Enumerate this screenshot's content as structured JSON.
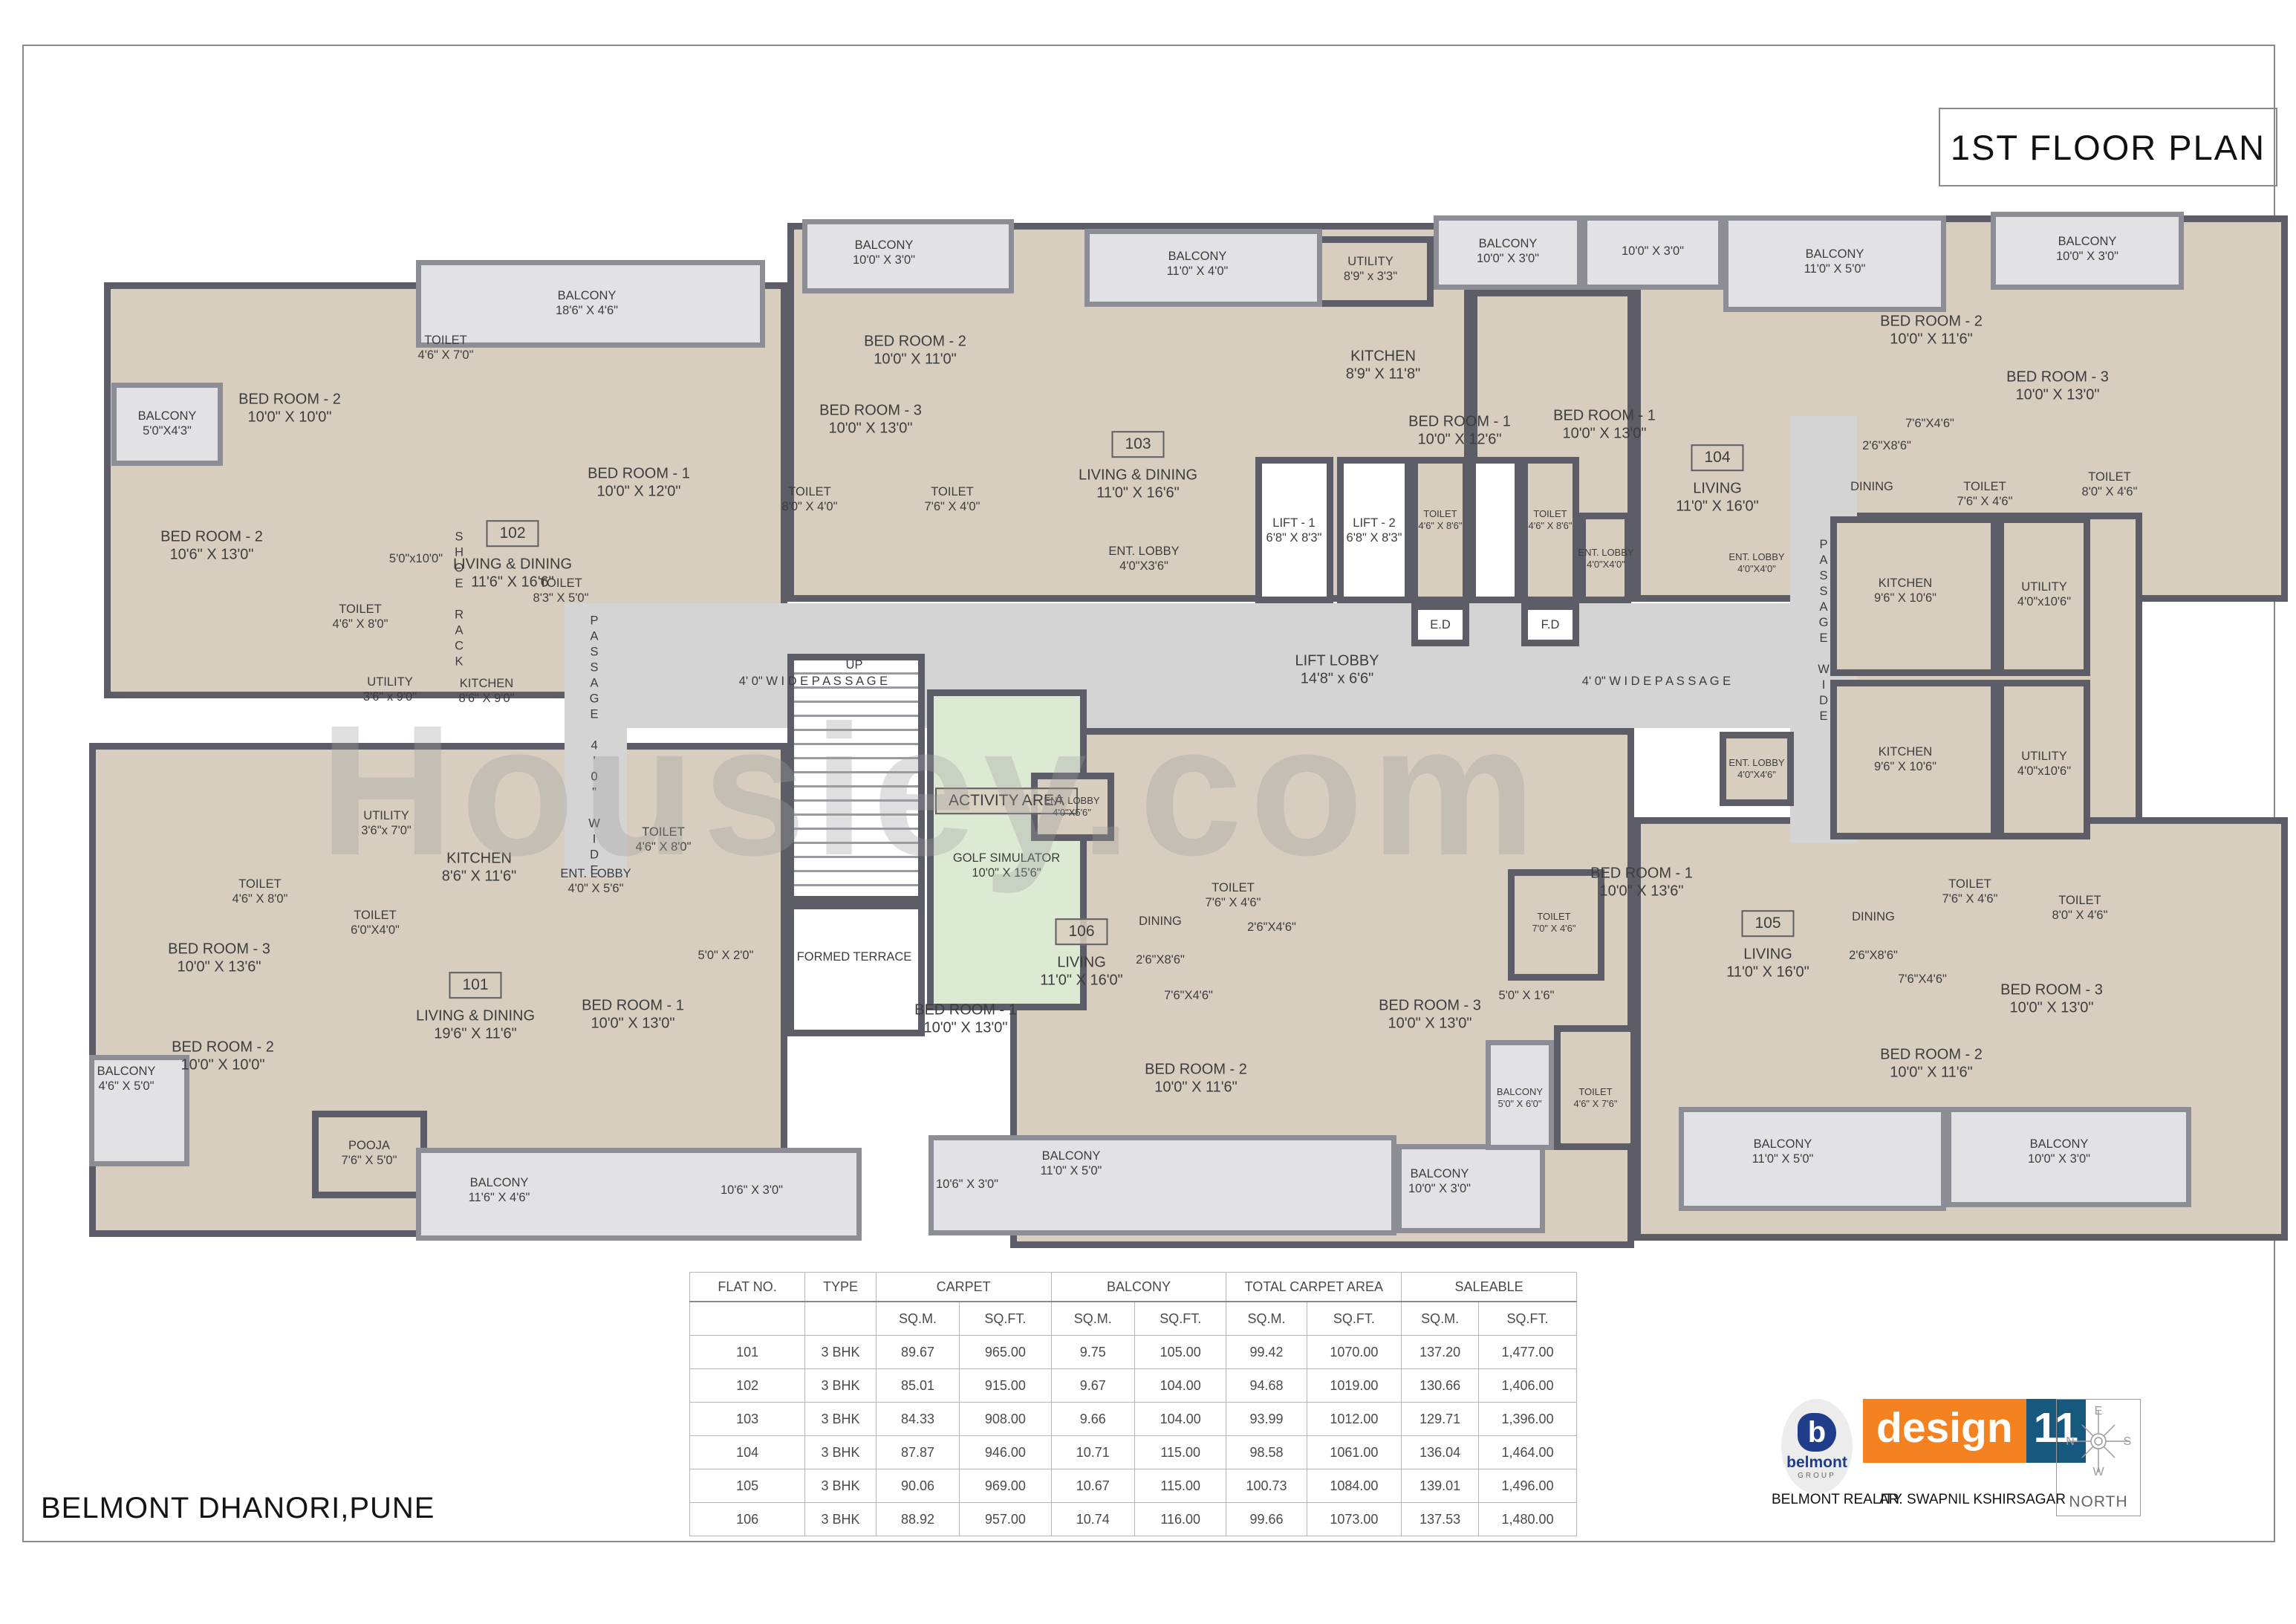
{
  "title": "1ST FLOOR PLAN",
  "project": "BELMONT  DHANORI,PUNE",
  "watermark": "Housiey.com",
  "footer": {
    "developer_label": "BELMONT REALITY",
    "architect_label": "AR. SWAPNIL  KSHIRSAGAR",
    "brand_word": "design",
    "brand_number": "11",
    "logo_letter": "b",
    "logo_name": "belmont",
    "logo_sub": "GROUP",
    "north_label": "NORTH",
    "compass": {
      "top": "E",
      "left": "N",
      "right": "S",
      "bottom": "W"
    }
  },
  "colors": {
    "room_fill": "#d8cec0",
    "wall": "#5d5d68",
    "balcony_fill": "#e2e2e4",
    "core_fill": "#d4d4d4",
    "activity_fill": "#dcead4",
    "brand_orange": "#f58220",
    "brand_blue": "#16587e",
    "logo_navy": "#1f3d8a"
  },
  "area_table": {
    "groups": [
      {
        "label": "FLAT NO.",
        "cols": 1
      },
      {
        "label": "TYPE",
        "cols": 1
      },
      {
        "label": "CARPET",
        "cols": 2
      },
      {
        "label": "BALCONY",
        "cols": 2
      },
      {
        "label": "TOTAL CARPET AREA",
        "cols": 2
      },
      {
        "label": "SALEABLE",
        "cols": 2
      }
    ],
    "unit_row": [
      "",
      "",
      "SQ.M.",
      "SQ.FT.",
      "SQ.M.",
      "SQ.FT.",
      "SQ.M.",
      "SQ.FT.",
      "SQ.M.",
      "SQ.FT."
    ],
    "rows": [
      [
        "101",
        "3 BHK",
        "89.67",
        "965.00",
        "9.75",
        "105.00",
        "99.42",
        "1070.00",
        "137.20",
        "1,477.00"
      ],
      [
        "102",
        "3 BHK",
        "85.01",
        "915.00",
        "9.67",
        "104.00",
        "94.68",
        "1019.00",
        "130.66",
        "1,406.00"
      ],
      [
        "103",
        "3 BHK",
        "84.33",
        "908.00",
        "9.66",
        "104.00",
        "93.99",
        "1012.00",
        "129.71",
        "1,396.00"
      ],
      [
        "104",
        "3 BHK",
        "87.87",
        "946.00",
        "10.71",
        "115.00",
        "98.58",
        "1061.00",
        "136.04",
        "1,464.00"
      ],
      [
        "105",
        "3 BHK",
        "90.06",
        "969.00",
        "10.67",
        "115.00",
        "100.73",
        "1084.00",
        "139.01",
        "1,496.00"
      ],
      [
        "106",
        "3 BHK",
        "88.92",
        "957.00",
        "10.74",
        "116.00",
        "99.66",
        "1073.00",
        "137.53",
        "1,480.00"
      ]
    ]
  },
  "plan": {
    "rooms": [
      [
        140,
        380,
        920,
        560,
        "r"
      ],
      [
        120,
        1000,
        940,
        665,
        "r"
      ],
      [
        1060,
        300,
        920,
        510,
        "r"
      ],
      [
        1980,
        390,
        220,
        420,
        "r"
      ],
      [
        2200,
        290,
        880,
        520,
        "r"
      ],
      [
        2464,
        690,
        420,
        440,
        "r"
      ],
      [
        2200,
        1100,
        880,
        570,
        "r"
      ],
      [
        1360,
        980,
        840,
        700,
        "r"
      ],
      [
        760,
        812,
        1660,
        168,
        "c"
      ],
      [
        760,
        870,
        84,
        310,
        "c"
      ],
      [
        2410,
        560,
        90,
        575,
        "c"
      ],
      [
        1690,
        615,
        105,
        197,
        "w"
      ],
      [
        1800,
        615,
        100,
        197,
        "w"
      ],
      [
        1900,
        615,
        78,
        197,
        "r"
      ],
      [
        1978,
        615,
        70,
        197,
        "w"
      ],
      [
        2048,
        615,
        78,
        197,
        "r"
      ],
      [
        1900,
        812,
        78,
        58,
        "w"
      ],
      [
        2048,
        812,
        78,
        58,
        "w"
      ],
      [
        2126,
        690,
        70,
        122,
        "r"
      ],
      [
        1060,
        880,
        185,
        335,
        "st"
      ],
      [
        1248,
        928,
        215,
        432,
        "g"
      ],
      [
        1060,
        1215,
        185,
        180,
        "w"
      ],
      [
        1388,
        1040,
        112,
        92,
        "r"
      ],
      [
        1760,
        318,
        170,
        95,
        "r"
      ],
      [
        420,
        1495,
        155,
        118,
        "r"
      ],
      [
        2464,
        695,
        225,
        215,
        "r"
      ],
      [
        2689,
        695,
        125,
        215,
        "r"
      ],
      [
        2464,
        915,
        225,
        215,
        "r"
      ],
      [
        2689,
        915,
        125,
        215,
        "r"
      ],
      [
        2315,
        985,
        100,
        100,
        "r"
      ],
      [
        2030,
        1170,
        130,
        150,
        "r"
      ],
      [
        2092,
        1380,
        112,
        168,
        "r"
      ],
      [
        150,
        515,
        150,
        112,
        "b"
      ],
      [
        560,
        350,
        470,
        118,
        "b"
      ],
      [
        1080,
        295,
        285,
        100,
        "b"
      ],
      [
        1460,
        308,
        320,
        105,
        "b"
      ],
      [
        1930,
        290,
        200,
        100,
        "b"
      ],
      [
        2130,
        290,
        190,
        100,
        "b"
      ],
      [
        2320,
        290,
        300,
        130,
        "b"
      ],
      [
        2680,
        285,
        260,
        105,
        "b"
      ],
      [
        120,
        1420,
        135,
        150,
        "b"
      ],
      [
        560,
        1545,
        600,
        125,
        "b"
      ],
      [
        1250,
        1528,
        630,
        135,
        "b"
      ],
      [
        1880,
        1540,
        200,
        120,
        "b"
      ],
      [
        2000,
        1400,
        92,
        148,
        "b"
      ],
      [
        2260,
        1490,
        360,
        140,
        "b"
      ],
      [
        2620,
        1490,
        330,
        135,
        "b"
      ]
    ],
    "labels": [
      [
        225,
        570,
        "BALCONY",
        "5'0\"X4'3\"",
        "s"
      ],
      [
        285,
        735,
        "BED ROOM - 2",
        "10'6\" X 13'0\"",
        ""
      ],
      [
        390,
        550,
        "BED ROOM - 2",
        "10'0\" X 10'0\"",
        ""
      ],
      [
        600,
        468,
        "TOILET",
        "4'6\" X 7'0\"",
        "s"
      ],
      [
        790,
        408,
        "BALCONY",
        "18'6\" X 4'6\"",
        "s"
      ],
      [
        860,
        650,
        "BED ROOM - 1",
        "10'0\" X 12'0\"",
        ""
      ],
      [
        485,
        830,
        "TOILET",
        "4'6\" X 8'0\"",
        "s"
      ],
      [
        560,
        752,
        "5'0\"x10'0\"",
        "",
        "s"
      ],
      [
        690,
        718,
        "102",
        "",
        "bx"
      ],
      [
        690,
        772,
        "LIVING & DINING",
        "11'6\" X 16'6\"",
        ""
      ],
      [
        525,
        928,
        "UTILITY",
        "3'6\" x 9'0\"",
        "s"
      ],
      [
        655,
        930,
        "KITCHEN",
        "8'6\" X 9'0\"",
        "s"
      ],
      [
        618,
        808,
        "SHOE RACK",
        "",
        "v"
      ],
      [
        755,
        795,
        "TOILET",
        "8'3\" X 5'0\"",
        "s"
      ],
      [
        800,
        1005,
        "PASSAGE 4'0\" WIDE",
        "",
        "v"
      ],
      [
        295,
        1290,
        "BED ROOM - 3",
        "10'0\" X 13'6\"",
        ""
      ],
      [
        350,
        1200,
        "TOILET",
        "4'6\" X 8'0\"",
        "s"
      ],
      [
        505,
        1242,
        "TOILET",
        "6'0\"X4'0\"",
        "s"
      ],
      [
        520,
        1108,
        "UTILITY",
        "3'6\"x 7'0\"",
        "s"
      ],
      [
        645,
        1168,
        "KITCHEN",
        "8'6\" X 11'6\"",
        ""
      ],
      [
        170,
        1452,
        "BALCONY",
        "4'6\" X 5'0\"",
        "s"
      ],
      [
        300,
        1422,
        "BED ROOM - 2",
        "10'0\" X 10'0\"",
        ""
      ],
      [
        497,
        1552,
        "POOJA",
        "7'6\" X 5'0\"",
        "s"
      ],
      [
        640,
        1326,
        "101",
        "",
        "bx"
      ],
      [
        640,
        1380,
        "LIVING & DINING",
        "19'6\" X 11'6\"",
        ""
      ],
      [
        852,
        1366,
        "BED ROOM - 1",
        "10'0\" X 13'0\"",
        ""
      ],
      [
        672,
        1602,
        "BALCONY",
        "11'6\" X 4'6\"",
        "s"
      ],
      [
        1012,
        1602,
        "10'6\" X 3'0\"",
        "",
        "s"
      ],
      [
        977,
        1286,
        "5'0\" X 2'0\"",
        "",
        "s"
      ],
      [
        802,
        1186,
        "ENT. LOBBY",
        "4'0\" X 5'6\"",
        "s"
      ],
      [
        893,
        1130,
        "TOILET",
        "4'6\" X 8'0\"",
        "s"
      ],
      [
        1190,
        340,
        "BALCONY",
        "10'0\" X 3'0\"",
        "s"
      ],
      [
        1232,
        472,
        "BED ROOM - 2",
        "10'0\" X 11'0\"",
        ""
      ],
      [
        1612,
        355,
        "BALCONY",
        "11'0\" X 4'0\"",
        "s"
      ],
      [
        1845,
        362,
        "UTILITY",
        "8'9\" x 3'3\"",
        "s"
      ],
      [
        1862,
        492,
        "KITCHEN",
        "8'9\" X 11'8\"",
        ""
      ],
      [
        1172,
        565,
        "BED ROOM - 3",
        "10'0\" X 13'0\"",
        ""
      ],
      [
        1090,
        672,
        "TOILET",
        "8'0\" X 4'0\"",
        "s"
      ],
      [
        1282,
        672,
        "TOILET",
        "7'6\" X 4'0\"",
        "s"
      ],
      [
        1532,
        598,
        "103",
        "",
        "bx"
      ],
      [
        1532,
        652,
        "LIVING & DINING",
        "11'0\" X 16'6\"",
        ""
      ],
      [
        1540,
        752,
        "ENT. LOBBY",
        "4'0\"X3'6\"",
        "s"
      ],
      [
        1742,
        714,
        "LIFT - 1",
        "6'8\" X 8'3\"",
        "s"
      ],
      [
        1850,
        714,
        "LIFT - 2",
        "6'8\" X 8'3\"",
        "s"
      ],
      [
        1939,
        700,
        "TOILET",
        "4'6\" X 8'6\"",
        "t"
      ],
      [
        2087,
        700,
        "TOILET",
        "4'6\" X 8'6\"",
        "t"
      ],
      [
        1939,
        841,
        "E.D",
        "",
        "s"
      ],
      [
        2087,
        841,
        "F.D",
        "",
        "s"
      ],
      [
        2162,
        752,
        "ENT. LOBBY",
        "4'0\"X4'0\"",
        "t"
      ],
      [
        1800,
        902,
        "LIFT LOBBY",
        "14'8\" x 6'6\"",
        ""
      ],
      [
        1095,
        917,
        "4' 0\" W I D E   P A S S A G E",
        "",
        "s"
      ],
      [
        2230,
        917,
        "4' 0\" W I D E   P A S S A G E",
        "",
        "s"
      ],
      [
        1150,
        895,
        "UP",
        "",
        "s"
      ],
      [
        1355,
        1078,
        "ACTIVITY AREA",
        "",
        "bx"
      ],
      [
        1355,
        1165,
        "GOLF SIMULATOR",
        "10'0\" X 15'6\"",
        "s"
      ],
      [
        1150,
        1288,
        "FORMED TERRACE",
        "",
        "s"
      ],
      [
        2455,
        850,
        "PASSAGE WIDE",
        "",
        "v"
      ],
      [
        1443,
        1086,
        "ENT. LOBBY",
        "4'0\"X5'6\"",
        "t"
      ],
      [
        1456,
        1254,
        "106",
        "",
        "bx"
      ],
      [
        1456,
        1308,
        "LIVING",
        "11'0\" X 16'0\"",
        ""
      ],
      [
        1562,
        1240,
        "DINING",
        "",
        "s"
      ],
      [
        1562,
        1292,
        "2'6\"X8'6\"",
        "",
        "s"
      ],
      [
        1660,
        1205,
        "TOILET",
        "7'6\" X 4'6\"",
        "s"
      ],
      [
        1712,
        1248,
        "2'6\"X4'6\"",
        "",
        "s"
      ],
      [
        1600,
        1340,
        "7'6\"X4'6\"",
        "",
        "s"
      ],
      [
        1300,
        1372,
        "BED ROOM - 1",
        "10'0\" X 13'0\"",
        ""
      ],
      [
        1610,
        1452,
        "BED ROOM - 2",
        "10'0\" X 11'6\"",
        ""
      ],
      [
        1442,
        1566,
        "BALCONY",
        "11'0\" X 5'0\"",
        "s"
      ],
      [
        1302,
        1594,
        "10'6\" X 3'0\"",
        "",
        "s"
      ],
      [
        1925,
        1366,
        "BED ROOM - 3",
        "10'0\" X 13'0\"",
        ""
      ],
      [
        1938,
        1590,
        "BALCONY",
        "10'0\" X 3'0\"",
        "s"
      ],
      [
        2055,
        1340,
        "5'0\" X 1'6\"",
        "",
        "s"
      ],
      [
        2046,
        1478,
        "BALCONY",
        "5'0\" X 6'0\"",
        "t"
      ],
      [
        2148,
        1478,
        "TOILET",
        "4'6\" X 7'6\"",
        "t"
      ],
      [
        2210,
        1188,
        "BED ROOM - 1",
        "10'0\" X 13'6\"",
        ""
      ],
      [
        2092,
        1242,
        "TOILET",
        "7'0\" X 4'6\"",
        "t"
      ],
      [
        2380,
        1243,
        "105",
        "",
        "bx"
      ],
      [
        2380,
        1297,
        "LIVING",
        "11'0\" X 16'0\"",
        ""
      ],
      [
        2522,
        1234,
        "DINING",
        "",
        "s"
      ],
      [
        2522,
        1286,
        "2'6\"X8'6\"",
        "",
        "s"
      ],
      [
        2588,
        1318,
        "7'6\"X4'6\"",
        "",
        "s"
      ],
      [
        2652,
        1200,
        "TOILET",
        "7'6\" X 4'6\"",
        "s"
      ],
      [
        2800,
        1222,
        "TOILET",
        "8'0\" X 4'6\"",
        "s"
      ],
      [
        2762,
        1345,
        "BED ROOM - 3",
        "10'0\" X 13'0\"",
        ""
      ],
      [
        2600,
        1432,
        "BED ROOM - 2",
        "10'0\" X 11'6\"",
        ""
      ],
      [
        2400,
        1550,
        "BALCONY",
        "11'0\" X 5'0\"",
        "s"
      ],
      [
        2772,
        1550,
        "BALCONY",
        "10'0\" X 3'0\"",
        "s"
      ],
      [
        2030,
        338,
        "BALCONY",
        "10'0\" X 3'0\"",
        "s"
      ],
      [
        2225,
        338,
        "10'0\" X 3'0\"",
        "",
        "s"
      ],
      [
        2470,
        352,
        "BALCONY",
        "11'0\" X 5'0\"",
        "s"
      ],
      [
        2810,
        335,
        "BALCONY",
        "10'0\" X 3'0\"",
        "s"
      ],
      [
        1965,
        580,
        "BED ROOM - 1",
        "10'0\" X 12'6\"",
        ""
      ],
      [
        2160,
        572,
        "BED ROOM - 1",
        "10'0\" X 13'0\"",
        ""
      ],
      [
        2312,
        616,
        "104",
        "",
        "bx"
      ],
      [
        2312,
        670,
        "LIVING",
        "11'0\" X 16'0\"",
        ""
      ],
      [
        2600,
        445,
        "BED ROOM - 2",
        "10'0\" X 11'6\"",
        ""
      ],
      [
        2770,
        520,
        "BED ROOM - 3",
        "10'0\" X 13'0\"",
        ""
      ],
      [
        2598,
        570,
        "7'6\"X4'6\"",
        "",
        "s"
      ],
      [
        2540,
        600,
        "2'6\"X8'6\"",
        "",
        "s"
      ],
      [
        2520,
        655,
        "DINING",
        "",
        "s"
      ],
      [
        2672,
        665,
        "TOILET",
        "7'6\" X 4'6\"",
        "s"
      ],
      [
        2840,
        652,
        "TOILET",
        "8'0\" X 4'6\"",
        "s"
      ],
      [
        2565,
        795,
        "KITCHEN",
        "9'6\" X 10'6\"",
        "s"
      ],
      [
        2752,
        800,
        "UTILITY",
        "4'0\"x10'6\"",
        "s"
      ],
      [
        2565,
        1022,
        "KITCHEN",
        "9'6\" X 10'6\"",
        "s"
      ],
      [
        2752,
        1028,
        "UTILITY",
        "4'0\"x10'6\"",
        "s"
      ],
      [
        2365,
        1035,
        "ENT. LOBBY",
        "4'0\"X4'6\"",
        "t"
      ],
      [
        2365,
        758,
        "ENT. LOBBY",
        "4'0\"X4'0\"",
        "t"
      ]
    ]
  }
}
